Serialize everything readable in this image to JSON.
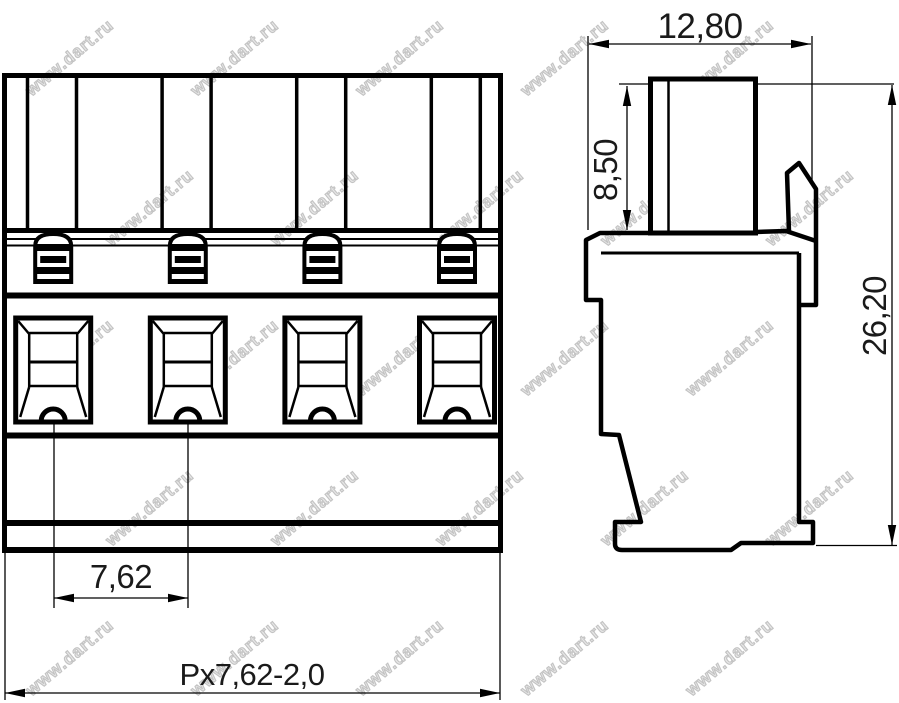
{
  "drawing": {
    "type": "technical-drawing",
    "positions_count": 4,
    "line_color": "#000000",
    "background_color": "#ffffff",
    "dimensions": {
      "body_width": "12,80",
      "pin_height": "8,50",
      "total_height": "26,20",
      "pitch": "7,62",
      "overall_width_formula": "Px7,62-2,0"
    }
  },
  "watermark": {
    "text": "www.dart.ru",
    "color": "#c3c3c3"
  }
}
